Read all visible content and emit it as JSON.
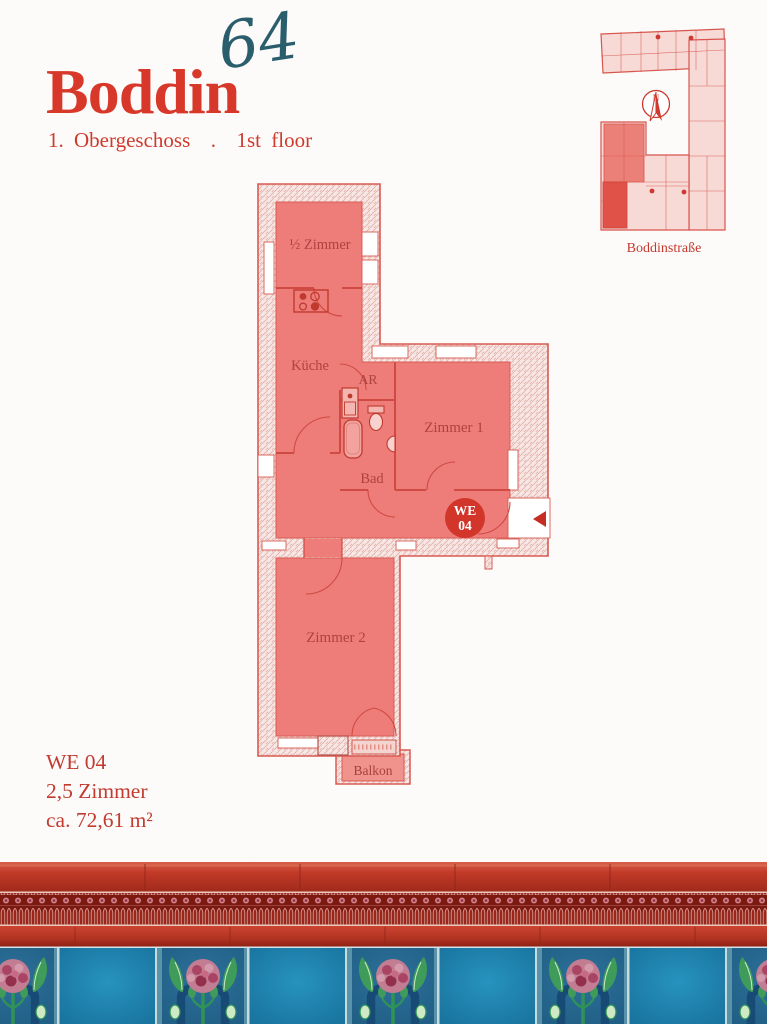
{
  "header": {
    "logo_text": "Boddin",
    "logo_number": "64",
    "subtitle": "1. Obergeschoss  .  1st floor"
  },
  "minimap": {
    "street_label": "Boddinstraße",
    "compass_n": "N"
  },
  "plan": {
    "rooms": {
      "half_room": "½ Zimmer",
      "kitchen": "Küche",
      "storage": "AR",
      "room1": "Zimmer 1",
      "bath": "Bad",
      "room2": "Zimmer 2",
      "balcony": "Balkon"
    },
    "unit_badge": {
      "top": "WE",
      "bottom": "04"
    }
  },
  "info": {
    "unit": "WE 04",
    "rooms": "2,5 Zimmer",
    "area": "ca. 72,61 m²"
  },
  "colors": {
    "accent_red": "#d8382a",
    "teal": "#2b5e6d",
    "plan_fill": "#ee7d79",
    "plan_wall_line": "#d85a52",
    "label_red": "#ae4240",
    "badge_red": "#d2352a",
    "tile_blue": "#1e82ac",
    "tile_red": "#bc3527",
    "frieze_maroon": "#7c1911"
  }
}
